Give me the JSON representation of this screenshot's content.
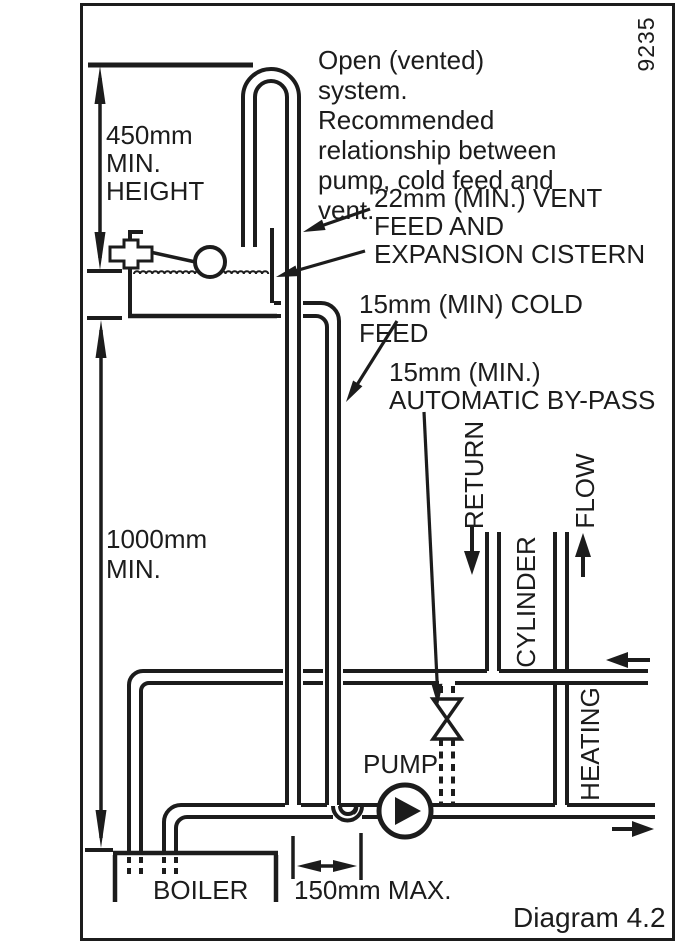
{
  "figure": {
    "drawing_number": "9235",
    "caption": "Diagram 4.2",
    "note": "Open (vented) system.\nRecommended\nrelationship between\npump, cold feed and vent."
  },
  "dimensions": {
    "min_height": "450mm\nMIN.\nHEIGHT",
    "min_drop": "1000mm\nMIN.",
    "max_pump_distance": "150mm MAX."
  },
  "labels": {
    "vent": "22mm (MIN.) VENT\nFEED AND\nEXPANSION CISTERN",
    "cold_feed": "15mm (MIN) COLD FEED",
    "bypass": "15mm (MIN.)\nAUTOMATIC BY-PASS",
    "pump": "PUMP",
    "boiler": "BOILER",
    "return_pipe": "RETURN",
    "cylinder": "CYLINDER",
    "flow": "FLOW",
    "heating": "HEATING"
  },
  "colors": {
    "ink": "#1c1c1c",
    "paper": "#ffffff"
  }
}
